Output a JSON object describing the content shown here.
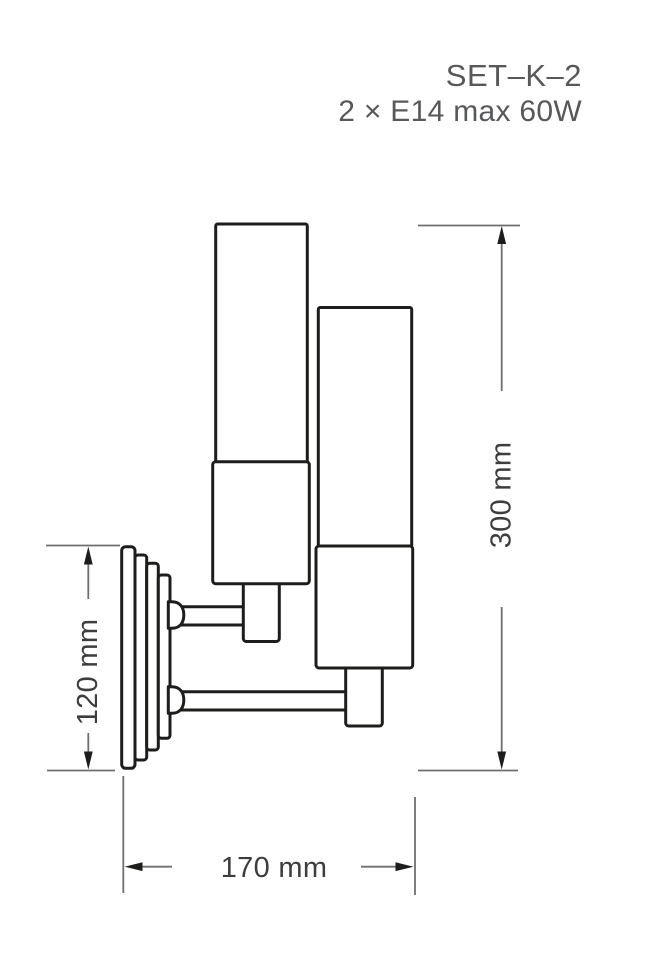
{
  "header": {
    "title": "SET–K–2",
    "subtitle": "2 × E14 max 60W"
  },
  "drawing": {
    "dimensions": {
      "height_label": "300 mm",
      "backplate_label": "120 mm",
      "depth_label": "170 mm"
    },
    "colors": {
      "outline": "#1d1d1b",
      "dimension_line": "#6f6f6f",
      "dimension_text": "#3d3d3d",
      "header_text": "#57585a",
      "background": "#ffffff"
    }
  }
}
